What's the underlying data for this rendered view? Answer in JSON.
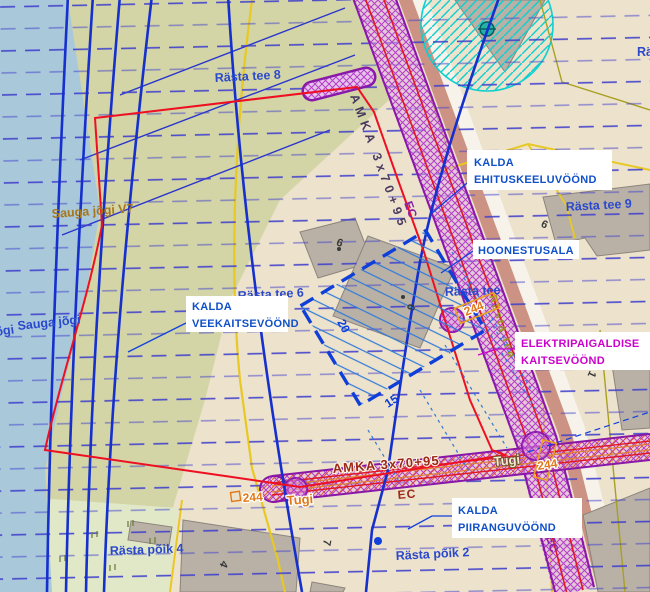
{
  "zone_labels": {
    "ehituskeelu": {
      "line1": "KALDA",
      "line2": "EHITUSKEELUVÖÖND"
    },
    "hoonestusala": {
      "line1": "HOONESTUSALA"
    },
    "veekaitse": {
      "line1": "KALDA",
      "line2": "VEEKAITSEVÖÖND"
    },
    "elektripaigaldis": {
      "line1": "ELEKTRIPAIGALDISE",
      "line2": "KAITSEVÖÖND"
    },
    "piirangu": {
      "line1": "KALDA",
      "line2": "PIIRANGUVÖÖND"
    }
  },
  "street_labels": {
    "rasta_tee_8": "Rästa tee 8",
    "rasta_tee_6": "Rästa tee 6",
    "rasta_tee_9": "Rästa tee 9",
    "rasta_tee": "Rästa tee",
    "rasta_tee_partial": "Rä",
    "rasta": "Rästa",
    "rasta_poik_4": "Rästa põik 4",
    "rasta_poik_2": "Rästa põik 2"
  },
  "water_labels": {
    "sauga_v": "Sauga jõgi V7",
    "sauga": "Sauga jõgi",
    "sauga_partial": "õgi"
  },
  "utility_labels": {
    "cable_top": "AMKA 3x70+95",
    "cable_bottom": "AMKA 3x70+95",
    "ec_top": "EC",
    "ec_bottom": "EC",
    "ec_lower": "EC",
    "pole_left": "Tugi",
    "pole_right": "Tugi",
    "pole_no_left": "244",
    "pole_no_right": "244",
    "pole_no_mid": "244",
    "road_name_along": "Rästa tee"
  },
  "dimension_labels": {
    "side_a": "20",
    "side_b": "15"
  },
  "building_numbers": {
    "n9_upper": "9",
    "n6_center": "6",
    "n9_east": "9",
    "n1_east": "1",
    "n4_south": "4",
    "n7_south": "7"
  },
  "colors": {
    "background": "#ede2cc",
    "river": "#a9c8da",
    "vegetation": "#d3d5a6",
    "light_meadow": "#e0e8c8",
    "road_corridor_purple": "#b43cc8",
    "road_surface_salmon": "#c8897b",
    "cadastral_yellow": "#e8c822",
    "contour_blue": "#1530cc",
    "plan_boundary_red": "#ee1022",
    "well_zone_cyan": "#10cfcf",
    "label_blue": "#1050c8",
    "label_magenta": "#cc00cc",
    "pole_orange": "#e07818",
    "cable_text_red": "#9c2818"
  }
}
